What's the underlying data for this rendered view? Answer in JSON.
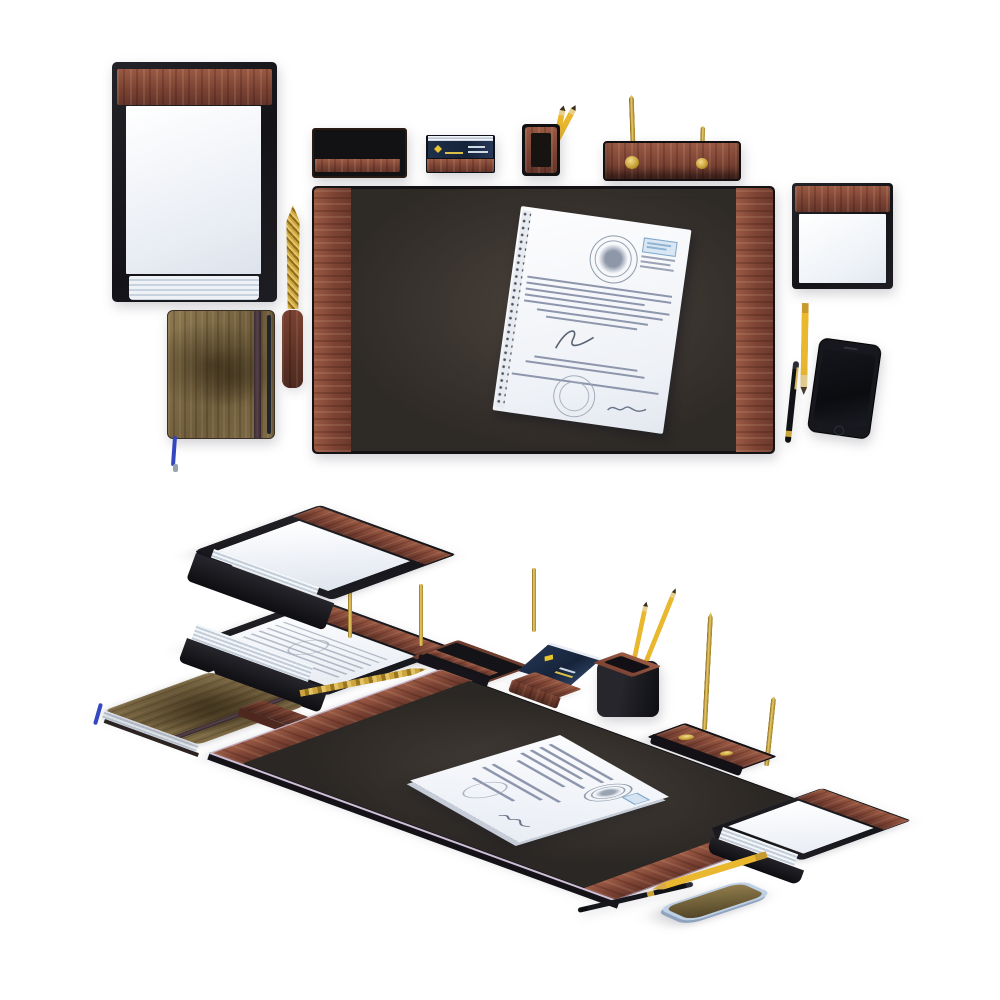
{
  "scene": {
    "type": "product-render",
    "subject": "Executive wooden desk accessory set",
    "background": "#ffffff",
    "views": [
      {
        "id": "top-flat-lay",
        "label": "Top view (flat lay)"
      },
      {
        "id": "isometric",
        "label": "Isometric view"
      }
    ]
  },
  "palette": {
    "wood_mid": "#8a4b38",
    "wood_light": "#a8604a",
    "wood_dark": "#5e3226",
    "leather_black": "#17171a",
    "desk_pad_surface": "#3e3831",
    "paper_white": "#f2f5f9",
    "paper_edge": "#c3cdd9",
    "brass_gold": "#d4ab45",
    "pencil_yellow": "#eab82e",
    "card_navy": "#1e2c44",
    "logo_yellow": "#e8c52f",
    "notebook_olive": "#7c6a43",
    "elastic_band": "#4e3a42",
    "ribbon_blue": "#3247c0",
    "phone_black": "#17181d",
    "phone_frame_iso": "#bdd0e6",
    "phone_screen_iso": "#6a5a35",
    "stamp_blue": "#7fa9cc",
    "stamp_gray": "#8f99aa"
  },
  "items": {
    "top_view": [
      "letter tray with paper stack",
      "letter opener (brass blade, wood handle)",
      "notebook with elastic band and blue ribbon",
      "desk pad with wood side rails",
      "document in sleeve with stamps and signatures",
      "pen tray",
      "business card box with navy cards",
      "pencil cup with two yellow pencils",
      "double pen stand with two brass pens",
      "memo pad holder",
      "yellow pencil",
      "black pen",
      "smartphone"
    ],
    "isometric_view": [
      "two-tier letter tray with brass posts",
      "notebook with elastic band and blue ribbon",
      "letter opener",
      "pen tray",
      "business card holder",
      "pencil cup with two yellow pencils",
      "desk pad with wood side rails",
      "document with stamps",
      "double pen stand with two brass pens",
      "memo pad holder",
      "smartphone",
      "yellow pencil",
      "black pen"
    ]
  }
}
